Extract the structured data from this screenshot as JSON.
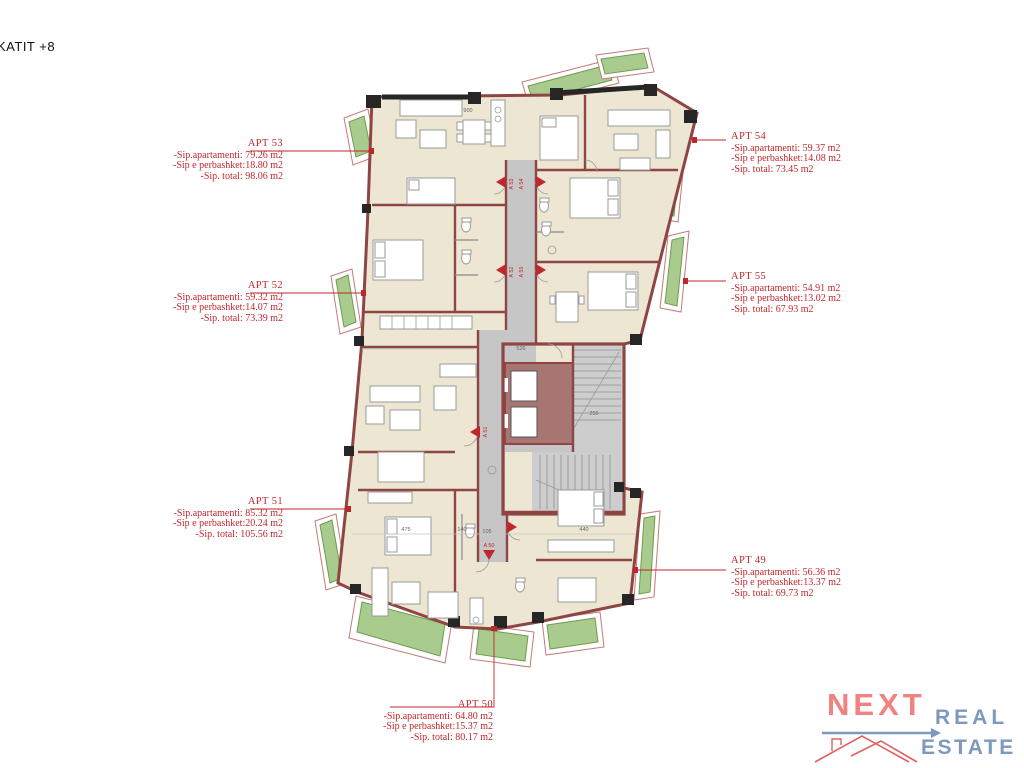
{
  "page_title": "KATIT +8",
  "colors": {
    "label_red": "#c0272c",
    "wall": "#8e4543",
    "black_wall": "#262626",
    "room_fill": "#ece6d3",
    "balcony_green": "#a9cb8e",
    "balcony_green_border": "#729b54",
    "corridor_gray": "#c6c6c6",
    "furn_gray": "#9a9a9a",
    "logo_coral": "#f2827f",
    "logo_blue": "#7d99bd",
    "roof_red": "#e26060"
  },
  "apartments": [
    {
      "name": "APT 53",
      "line1": "-Sip.apartamenti: 79.26 m2",
      "line2": "-Sip e perbashket:18.80 m2",
      "line3": "-Sip. total: 98.06 m2"
    },
    {
      "name": "APT 54",
      "line1": "-Sip.apartamenti: 59.37 m2",
      "line2": "-Sip e perbashket:14.08 m2",
      "line3": "-Sip. total: 73.45 m2"
    },
    {
      "name": "APT 52",
      "line1": "-Sip.apartamenti: 59.32 m2",
      "line2": "-Sip e perbashket:14.07 m2",
      "line3": "-Sip. total: 73.39 m2"
    },
    {
      "name": "APT 55",
      "line1": "-Sip.apartamenti: 54.91 m2",
      "line2": "-Sip e perbashket:13.02 m2",
      "line3": "-Sip. total: 67.93 m2"
    },
    {
      "name": "APT 51",
      "line1": "-Sip.apartamenti: 85.32 m2",
      "line2": "-Sip e perbashket:20.24 m2",
      "line3": "-Sip. total: 105.56 m2"
    },
    {
      "name": "APT 49",
      "line1": "-Sip.apartamenti: 56.36 m2",
      "line2": "-Sip e perbashket:13.37 m2",
      "line3": "-Sip. total: 69.73 m2"
    },
    {
      "name": "APT 50",
      "line1": "-Sip.apartamenti: 64.80 m2",
      "line2": "-Sip e perbashket:15.37 m2",
      "line3": "-Sip. total: 80.17 m2"
    }
  ],
  "plan_markers": [
    "A 53",
    "A 54",
    "A 52",
    "A 55",
    "A 51",
    "A 50"
  ],
  "plan_dimensions": [
    "900",
    "526",
    "256",
    "475",
    "140",
    "105",
    "440"
  ],
  "logo": {
    "next": "NEXT",
    "real": "REAL",
    "estate": "ESTATE"
  }
}
